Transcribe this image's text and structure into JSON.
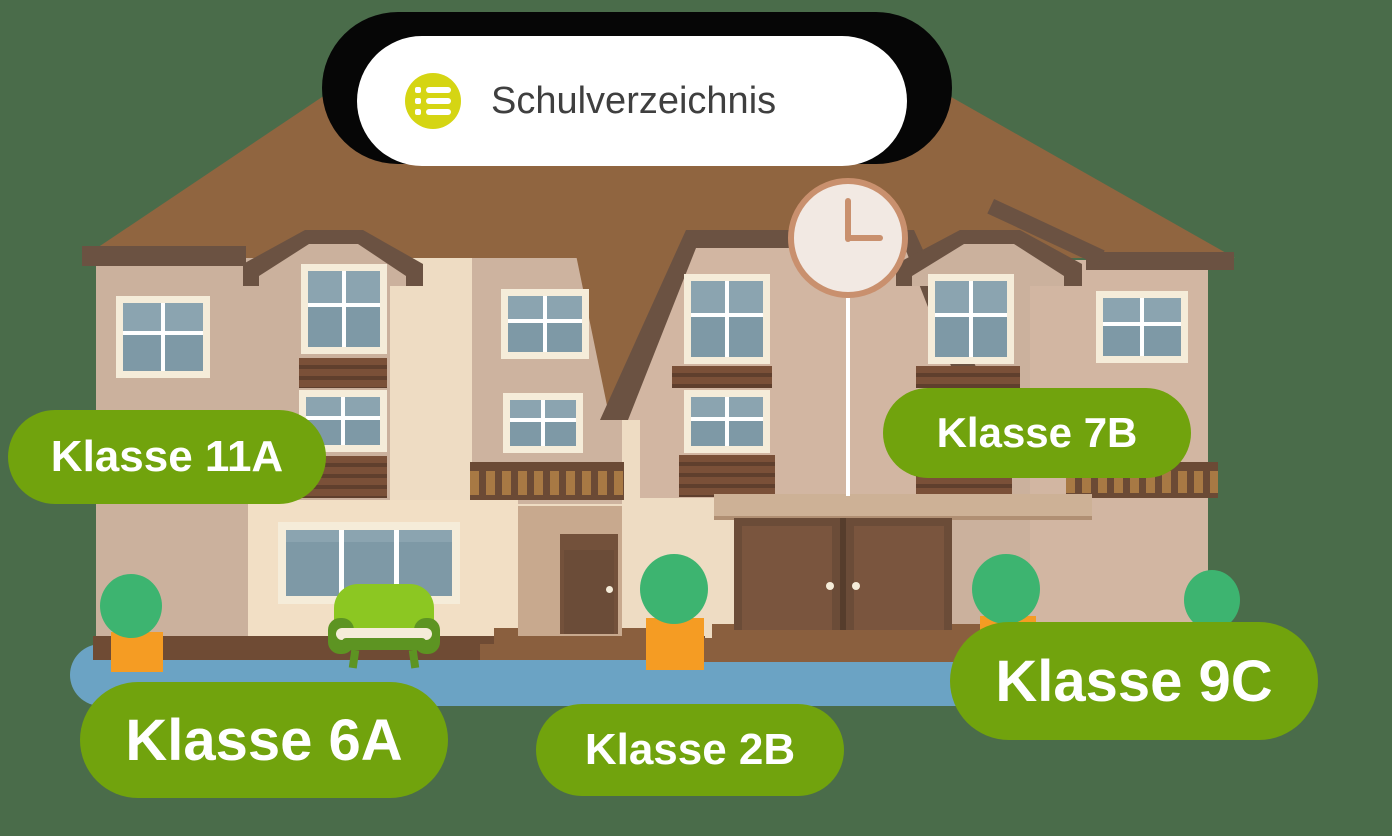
{
  "app": {
    "background_color": "#4a6c4a"
  },
  "header": {
    "title": "Schulverzeichnis",
    "icon": {
      "name": "list-icon",
      "circle_color": "#d5d513",
      "glyph_color": "#ffffff"
    },
    "pill_color": "#ffffff",
    "backdrop_color": "#060606",
    "text_color": "#3f3f3f"
  },
  "class_labels": [
    {
      "text": "Klasse 11A",
      "size": "medium"
    },
    {
      "text": "Klasse 7B",
      "size": "medium"
    },
    {
      "text": "Klasse 6A",
      "size": "large"
    },
    {
      "text": "Klasse 2B",
      "size": "medium"
    },
    {
      "text": "Klasse 9C",
      "size": "large"
    }
  ],
  "label_style": {
    "background_color": "#71a30d",
    "text_color": "#ffffff"
  },
  "scene": {
    "type": "school-building-illustration",
    "clock_time": "3:00",
    "colors": {
      "roof": "#906540",
      "roof_trim": "#6b5242",
      "wall_light": "#eedcc3",
      "wall_tan": "#cbb19d",
      "wall_rose": "#d2b6a2",
      "wall_pale": "#f2dfc5",
      "window_frame": "#f5ecd9",
      "window_pane": "#7e99a6",
      "window_pane_light": "#8ba4b0",
      "door_brown": "#6b4c38",
      "steps_brown": "#8a5f3e",
      "base_strip": "#6f4b34",
      "ground_blue": "#6ba3c4",
      "bush_green": "#3db470",
      "pot_orange": "#f59c23",
      "sofa_green": "#8cc722",
      "sofa_dark_green": "#5d9422",
      "clock_face": "#f2e9e3",
      "clock_rim": "#c9906e"
    }
  }
}
